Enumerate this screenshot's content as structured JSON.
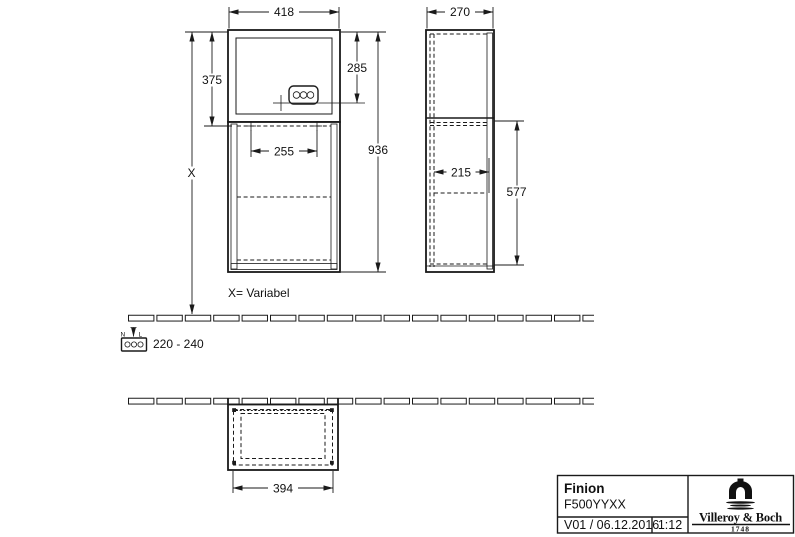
{
  "views": {
    "front": {
      "dims": {
        "width": "418",
        "upper_height": "375",
        "socket_height": "285",
        "total_height": "936",
        "inner_width": "255",
        "variable_height": "X"
      },
      "note": "X= Variabel"
    },
    "side": {
      "dims": {
        "depth": "270",
        "inner_depth": "215",
        "lower_height": "577"
      }
    },
    "bottom": {
      "dims": {
        "width": "394"
      }
    }
  },
  "electrical": {
    "label_n": "N",
    "label_l": "L",
    "voltage": "220 - 240"
  },
  "icons": {
    "legend": "power-socket-icon",
    "brand": "vb-aqueduct-icon"
  },
  "title_block": {
    "product_name": "Finion",
    "product_code": "F500YYXX",
    "version_date": "V01 / 06.12.2016",
    "scale": "1:12",
    "brand_name": "Villeroy & Boch",
    "brand_year": "1748"
  }
}
